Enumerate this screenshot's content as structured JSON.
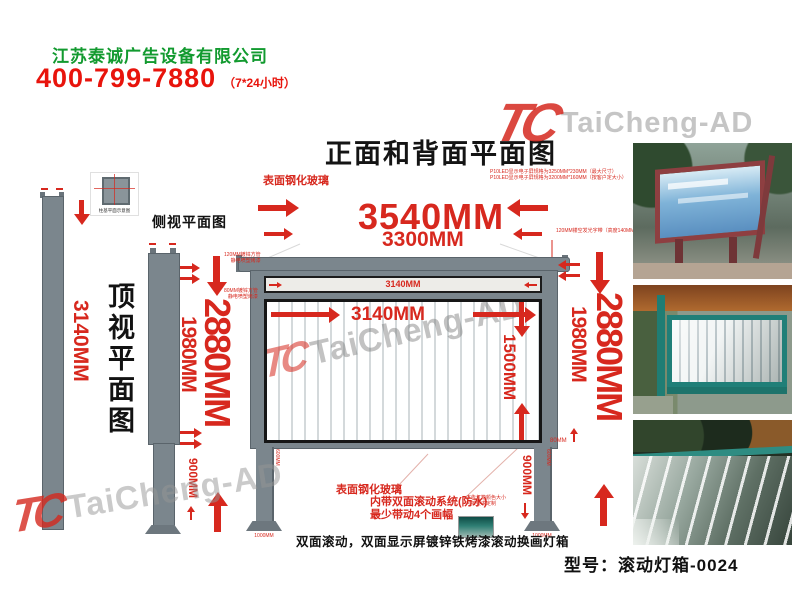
{
  "header": {
    "company": "江苏泰诚广告设备有限公司",
    "phone": "400-799-7880",
    "hours": "（7*24小时）"
  },
  "title": "正面和背面平面图",
  "watermark": {
    "monogram": "TC",
    "text": "TaiCheng-AD"
  },
  "left_panel": {
    "top_view_label": "顶视平面图",
    "top_view_dim": "3140MM",
    "detail_caption": "柱基平面示意图",
    "side_view_label": "侧视平面图"
  },
  "dims": {
    "outer_width": "3540MM",
    "inner_width": "3300MM",
    "strip_width": "3140MM",
    "window_width": "3140MM",
    "window_height": "1500MM",
    "left_outer_height": "2880MM",
    "left_inner_height": "1980MM",
    "left_leg_height": "900MM",
    "right_outer_height": "2880MM",
    "right_inner_height": "1980MM",
    "right_leg_height": "900MM",
    "small_80": "80MM",
    "leg_tube": "600MM",
    "base_width": "1000MM"
  },
  "notes": {
    "glass_top": "表面钢化玻璃",
    "led_line1": "P10LED显示电子屏规格为3250MM*230MM（最大尺寸）",
    "led_line2": "P10LED显示电子屏规格为3200MM*160MM（按客户定大小）",
    "lamp_band": "120MM镂空发光字带（高度140MM）",
    "frame_note1_l1": "120MM镀锌方管",
    "frame_note1_l2": "静电喷塑烤漆",
    "frame_note2_l1": "80MM镀锌方管",
    "frame_note2_l2": "静电喷塑烤漆",
    "glass_bottom": "表面钢化玻璃",
    "system_line1": "内带双面滚动系统(防水)",
    "system_line2": "最少带动4个画幅",
    "custom_l1": "广告灯箱颜色大小",
    "custom_l2": "可按要求定制",
    "bottom_caption": "双面滚动，双面显示屏镀锌铁烤漆滚动换画灯箱"
  },
  "footer": {
    "model": "型号：滚动灯箱-0024"
  },
  "photos": [
    {
      "name": "street-lightbox-red-frame"
    },
    {
      "name": "teal-frame-lightbox-rollers"
    },
    {
      "name": "glass-roller-closeup"
    }
  ],
  "colors": {
    "dim_red": "#d7281e",
    "phone_red": "#e8140c",
    "company_green": "#129a2f",
    "frame_gray": "#7b868d"
  }
}
